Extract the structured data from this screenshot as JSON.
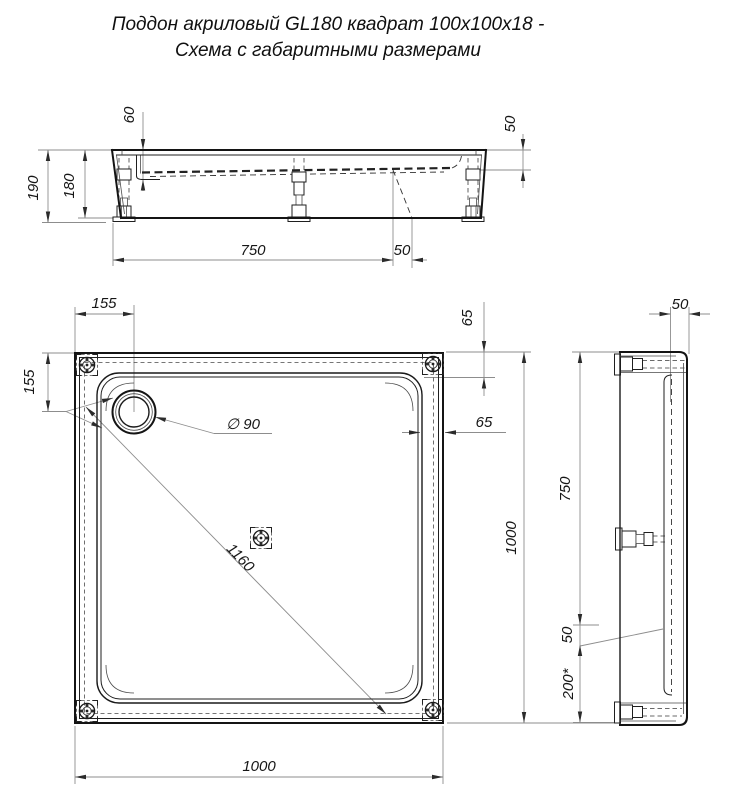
{
  "title": {
    "line1": "Поддон акриловый  GL180 квадрат 100x100x18 -",
    "line2": "Схема с габаритными размерами"
  },
  "dims": {
    "front_basin_depth": "60",
    "front_rim_drop": "50",
    "front_total_height": "190",
    "front_tray_height": "180",
    "front_feet_span": "750",
    "front_feet_offset": "50",
    "plan_drain_offset_x": "155",
    "plan_drain_offset_y": "155",
    "plan_drain_diameter": "∅ 90",
    "plan_rim_inset_top": "65",
    "plan_rim_inset_right": "65",
    "plan_diagonal": "1160",
    "plan_width": "1000",
    "plan_depth": "1000",
    "side_rim_width": "50",
    "side_feet_span": "750",
    "side_feet_gap": "50",
    "side_edge_offset": "200*"
  },
  "colors": {
    "line": "#141414",
    "thin": "#8d8d8d",
    "background": "#ffffff"
  }
}
